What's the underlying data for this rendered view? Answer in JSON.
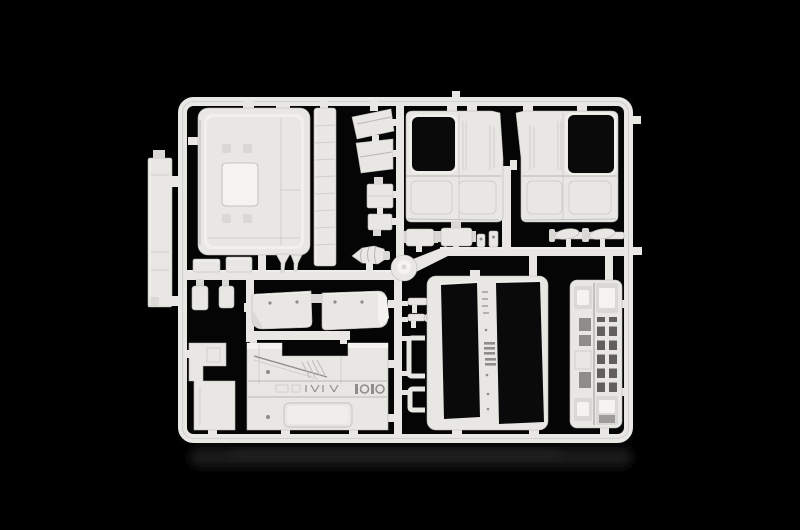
{
  "scene": {
    "description": "Photograph of a white plastic model-kit sprue (injection molding runner frame) holding unpainted truck-cab parts on a black background with a faint table reflection below",
    "colors": {
      "background": "#000000",
      "plastic": "#e8e7e4",
      "plastic-bright": "#f4f3f0",
      "plastic-dim": "#d9d8d5",
      "plastic-shadow": "#b7b6b3",
      "line-dark": "#8c8b88",
      "cutout": "#050505",
      "reflection": "#1d1d1c"
    },
    "parts": {
      "frame": {
        "label": "sprue runner frame"
      },
      "roof": {
        "label": "cab roof panel"
      },
      "side_stack": {
        "label": "tall side panel part"
      },
      "strip": {
        "label": "long step strip part"
      },
      "deflector_upper": {
        "label": "upper wind deflector"
      },
      "deflector_lower": {
        "label": "lower wind deflector"
      },
      "box_a": {
        "label": "small box part A"
      },
      "box_b": {
        "label": "small box part B"
      },
      "horn": {
        "label": "ribbed horn part"
      },
      "hub": {
        "label": "injection gate hub"
      },
      "door_left": {
        "label": "left cab door with window opening"
      },
      "door_right": {
        "label": "right cab door with window opening"
      },
      "muffler_a": {
        "label": "small cylinder part A"
      },
      "muffler_b": {
        "label": "small cylinder part B"
      },
      "clips": {
        "label": "small clip parts"
      },
      "wiper_bar": {
        "label": "wiper blade bar part"
      },
      "visor": {
        "label": "two-piece sun visor"
      },
      "small_box_row": {
        "label": "small bracket boxes"
      },
      "bottles": {
        "label": "small tank parts"
      },
      "funnels": {
        "label": "small funnel parts"
      },
      "mirror_brackets": {
        "label": "mirror bracket parts"
      },
      "square_brackets": {
        "label": "square bracket parts"
      },
      "rear_panel": {
        "label": "cab rear panel with engraved details"
      },
      "l_panel": {
        "label": "stepped side panel"
      },
      "window_frame": {
        "label": "cab panel with two window openings"
      },
      "grille": {
        "label": "front grille panel with headlight recesses"
      },
      "reflection": {
        "label": "table reflection"
      }
    }
  }
}
